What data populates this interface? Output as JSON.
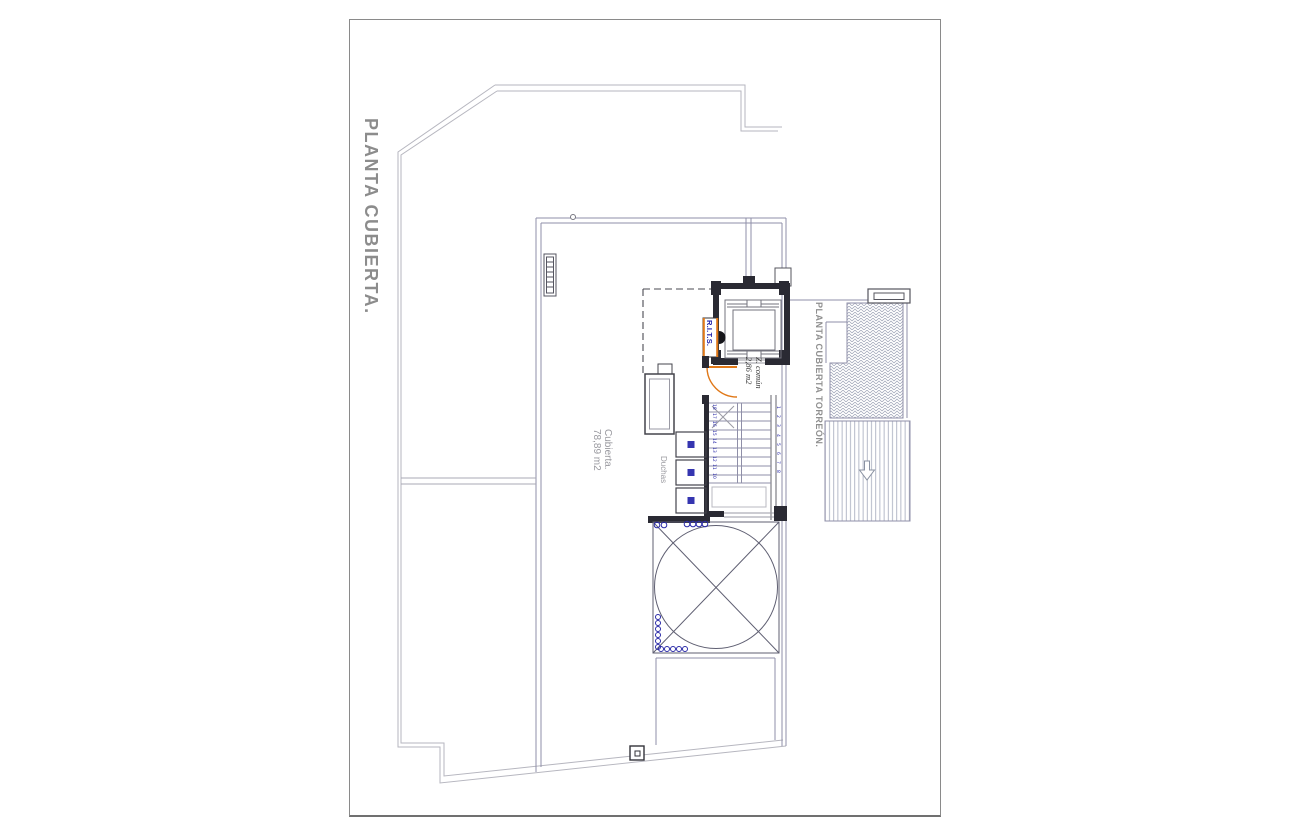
{
  "sheet": {
    "title_main": "PLANTA CUBIERTA.",
    "title_secondary": "PLANTA CUBIERTA TORREÓN."
  },
  "annotations": {
    "roof": {
      "label": "Cubierta.",
      "area": "78,89 m2"
    },
    "common_zone": {
      "label": "Z. común",
      "area": "2,86 m2"
    },
    "showers_label": "Duchas",
    "telecom_cabinet_label": "R.I.T.S."
  },
  "stairs": {
    "left_step_numbers": [
      "18",
      "17",
      "16",
      "15",
      "14",
      "13",
      "12",
      "11",
      "10"
    ],
    "right_step_numbers": [
      "1",
      "2",
      "3",
      "4",
      "5",
      "6",
      "7",
      "8"
    ]
  },
  "colors": {
    "accent_orange": "#e07818",
    "symbol_blue": "#2a2aa8",
    "title_gray": "#8c8c8c",
    "wall_dark": "#23232c",
    "line_blue_gray": "#8f8fa8",
    "line_light_gray": "#b6b6bf",
    "hatch_gray": "#9aa0b4"
  }
}
